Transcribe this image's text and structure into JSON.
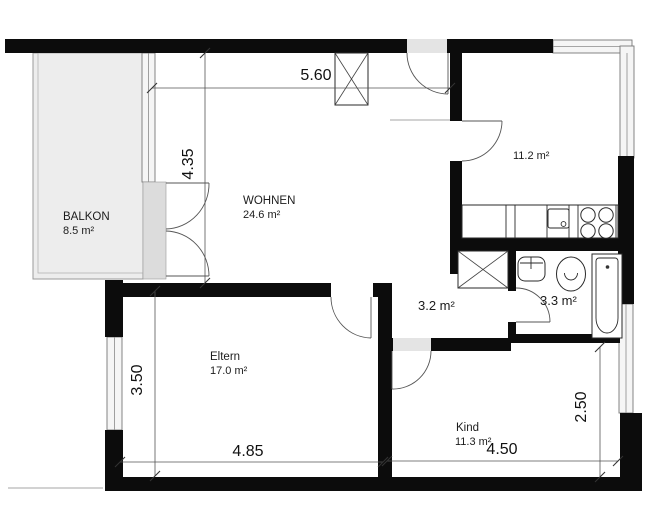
{
  "colors": {
    "wall": "#0c0c0c",
    "balcony_fill": "#ededed",
    "threshold_fill": "#dcdcdc",
    "door_gap_fill": "#e4e4e4"
  },
  "rooms": {
    "balkon": {
      "name": "BALKON",
      "area": "8.5 m²"
    },
    "wohnen": {
      "name": "WOHNEN",
      "area": "24.6 m²"
    },
    "kueche": {
      "area": "11.2 m²"
    },
    "flur": {
      "area": "3.2 m²"
    },
    "bad": {
      "area": "3.3 m²"
    },
    "eltern": {
      "name": "Eltern",
      "area": "17.0 m²"
    },
    "kind": {
      "name": "Kind",
      "area": "11.3 m²"
    }
  },
  "dimensions": {
    "wohnen_width": "5.60",
    "wohnen_depth": "4.35",
    "eltern_depth": "3.50",
    "eltern_width": "4.85",
    "kind_width": "4.50",
    "kind_depth": "2.50"
  }
}
